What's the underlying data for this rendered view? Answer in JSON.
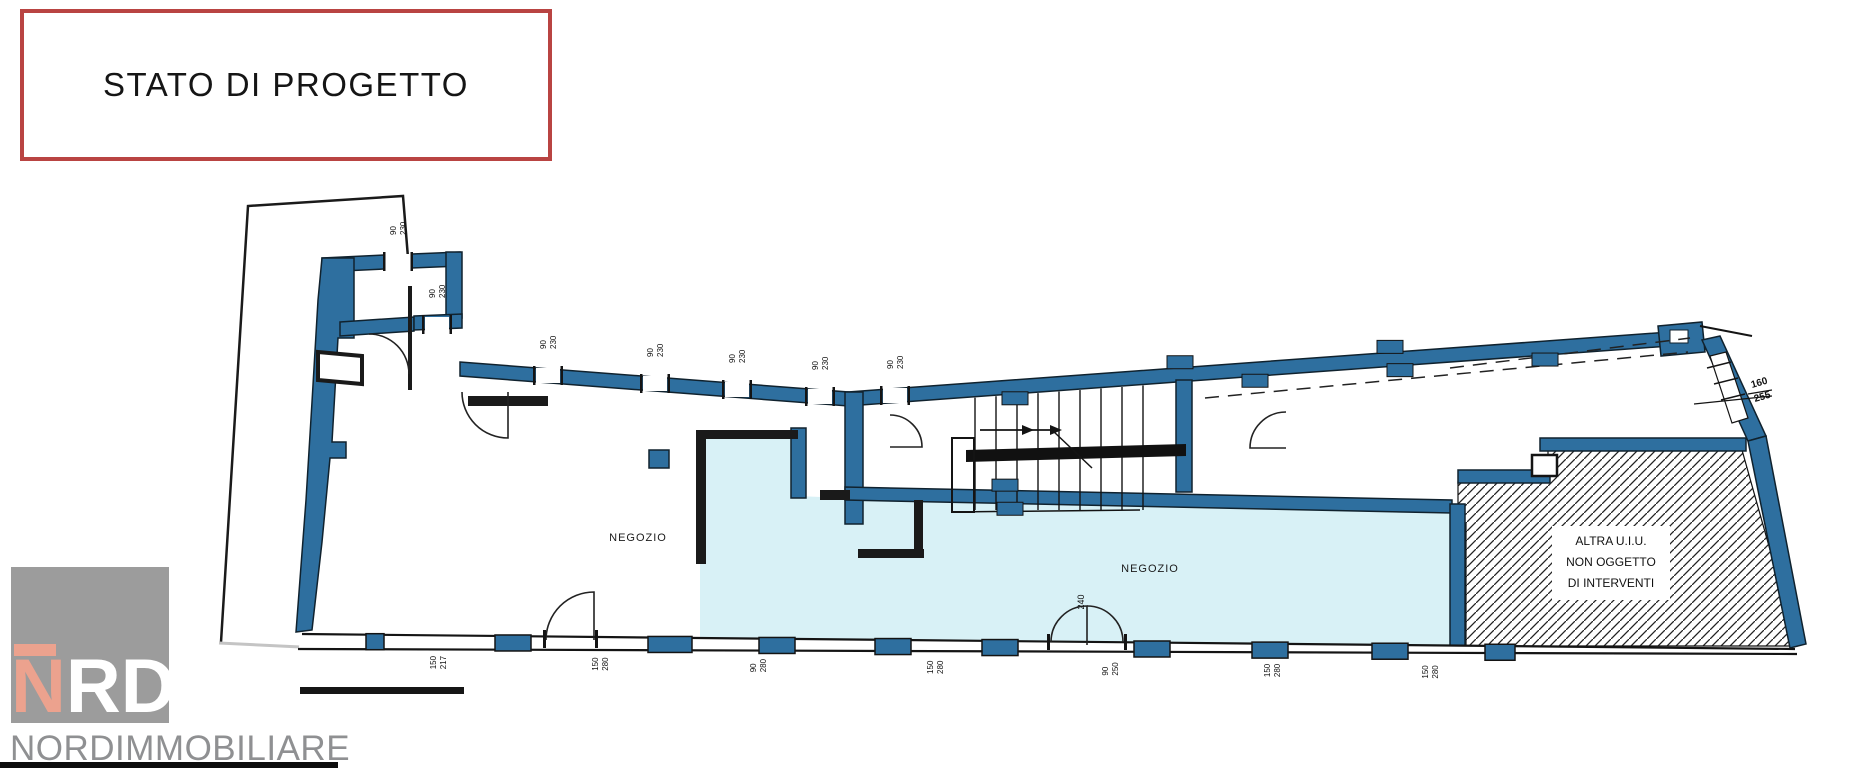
{
  "title_box": {
    "label": "STATO DI PROGETTO"
  },
  "plan": {
    "colors": {
      "wall": "#2e6f9f",
      "room_fill": "#d8f1f6",
      "outline": "#141414",
      "accent_red": "#b94442"
    },
    "room_labels": [
      {
        "text": "NEGOZIO",
        "x": 638,
        "y": 541
      },
      {
        "text": "NEGOZIO",
        "x": 1150,
        "y": 572
      }
    ],
    "area_note": {
      "x": 1611,
      "lines": [
        "ALTRA U.I.U.",
        "NON OGGETTO",
        "DI INTERVENTI"
      ]
    },
    "right_window_label": {
      "a": "160",
      "b": "255"
    },
    "door_label": {
      "value": "240"
    },
    "windows": [
      {
        "x": 398,
        "wy": 255,
        "a": "90",
        "b": "230"
      },
      {
        "x": 437,
        "wy": 318,
        "a": "90",
        "b": "230"
      },
      {
        "x": 548,
        "wy": 369,
        "a": "90",
        "b": "230"
      },
      {
        "x": 655,
        "wy": 377,
        "a": "90",
        "b": "230"
      },
      {
        "x": 737,
        "wy": 383,
        "a": "90",
        "b": "230"
      },
      {
        "x": 820,
        "wy": 390,
        "a": "90",
        "b": "230"
      },
      {
        "x": 895,
        "wy": 389,
        "a": "90",
        "b": "230"
      }
    ],
    "bottom_labels": [
      {
        "x": 438,
        "a": "150",
        "b": "217"
      },
      {
        "x": 600,
        "a": "150",
        "b": "280"
      },
      {
        "x": 758,
        "a": "90",
        "b": "280"
      },
      {
        "x": 935,
        "a": "150",
        "b": "280"
      },
      {
        "x": 1110,
        "a": "90",
        "b": "250"
      },
      {
        "x": 1272,
        "a": "150",
        "b": "280"
      },
      {
        "x": 1430,
        "a": "150",
        "b": "280"
      }
    ],
    "piers": {
      "below_top_wall": [
        1015,
        1255,
        1400,
        1545
      ],
      "above_top_wall": [
        1180,
        1390
      ],
      "below_mid_wall": [
        1010
      ],
      "above_mid_wall": [
        1005
      ]
    },
    "bottom_pillars": [
      {
        "x": 375,
        "w": 18
      },
      {
        "x": 513,
        "w": 36
      },
      {
        "x": 670,
        "w": 44
      },
      {
        "x": 777,
        "w": 36
      },
      {
        "x": 893,
        "w": 36
      },
      {
        "x": 1000,
        "w": 36
      },
      {
        "x": 1152,
        "w": 36
      },
      {
        "x": 1270,
        "w": 36
      },
      {
        "x": 1390,
        "w": 36
      },
      {
        "x": 1500,
        "w": 30
      }
    ]
  },
  "logo": {
    "letter_n": "N",
    "letters_rd": "RD",
    "company": "NORDIMMOBILIARE",
    "square_color": "#9c9c9c",
    "n_color": "#eca28e",
    "rd_color": "#ffffff",
    "text_color": "#8f9092"
  }
}
